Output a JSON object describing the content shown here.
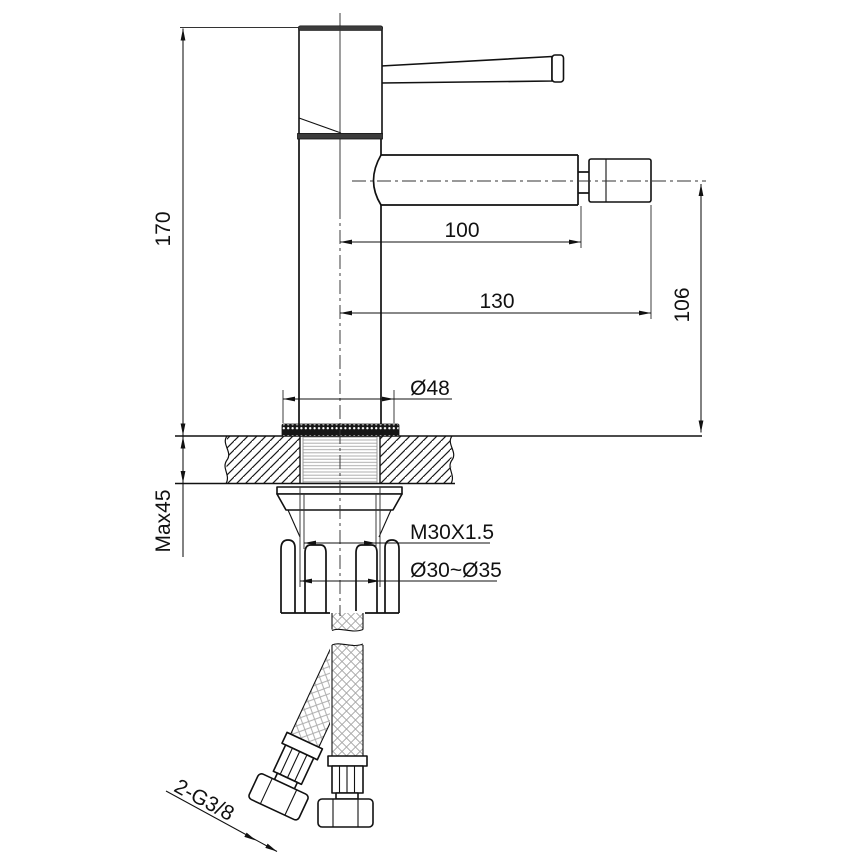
{
  "drawing": {
    "type": "technical-dimension-drawing",
    "subject": "single-lever bidet basin mixer tap, side elevation with deck cross-section and supply hoses",
    "background_color": "#ffffff",
    "line_color": "#111111",
    "hatch_color": "#1a1a1a",
    "braid_color": "#a9a9a9",
    "dimensions": {
      "overall_height": "170",
      "deck_thickness_max": "Max45",
      "spout_reach": "100",
      "overall_reach": "130",
      "spout_height": "106",
      "base_diameter": "Ø48",
      "thread_spec": "M30X1.5",
      "hole_diameter": "Ø30~Ø35",
      "hose_connection": "2-G3/8"
    }
  }
}
